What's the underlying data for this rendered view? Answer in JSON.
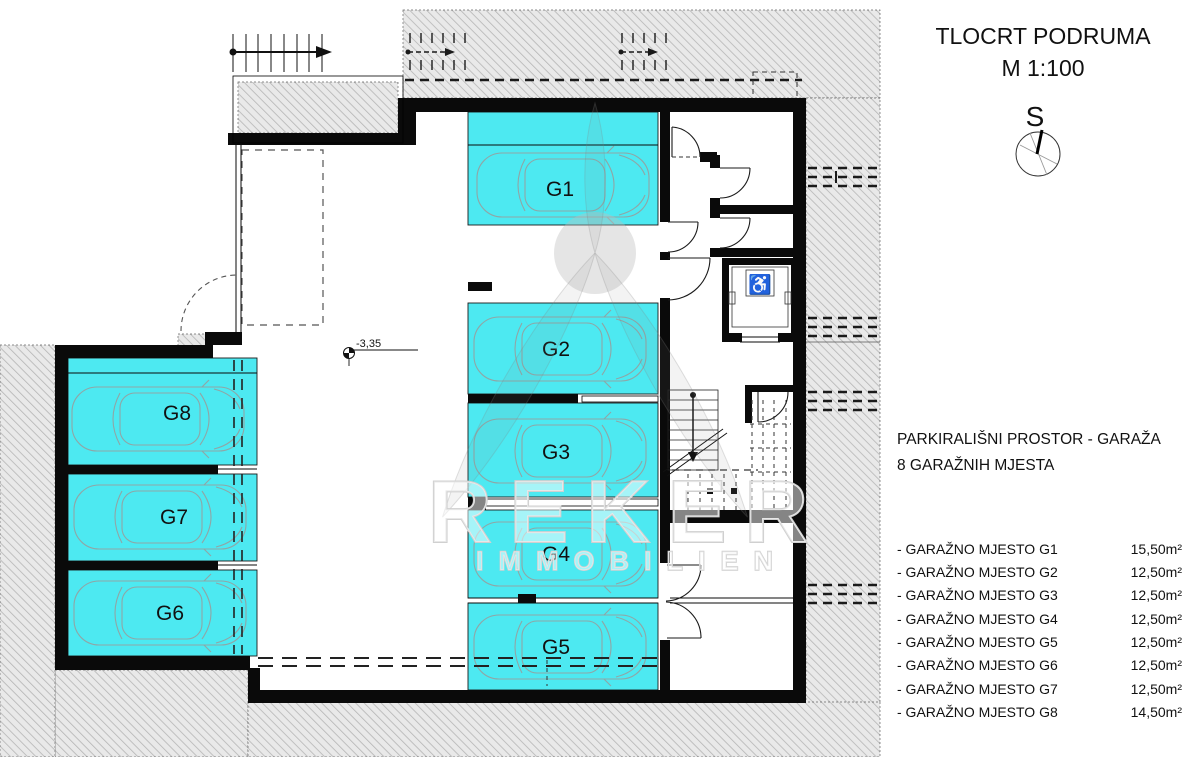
{
  "header": {
    "title": "TLOCRT PODRUMA",
    "scale": "M 1:100",
    "compass_label": "S"
  },
  "summary": {
    "line1": "PARKIRALIŠNI PROSTOR - GARAŽA",
    "line2": "8  GARAŽNIH MJESTA"
  },
  "stalls": [
    {
      "label": "G1",
      "area": "15,50m²"
    },
    {
      "label": "G2",
      "area": "12,50m²"
    },
    {
      "label": "G3",
      "area": "12,50m²"
    },
    {
      "label": "G4",
      "area": "12,50m²"
    },
    {
      "label": "G5",
      "area": "12,50m²"
    },
    {
      "label": "G6",
      "area": "12,50m²"
    },
    {
      "label": "G7",
      "area": "12,50m²"
    },
    {
      "label": "G8",
      "area": "14,50m²"
    }
  ],
  "legend": {
    "rows": [
      {
        "label": "- GARAŽNO MJESTO G1",
        "area": "15,50m²"
      },
      {
        "label": "- GARAŽNO MJESTO G2",
        "area": "12,50m²"
      },
      {
        "label": "- GARAŽNO MJESTO G3",
        "area": "12,50m²"
      },
      {
        "label": "- GARAŽNO MJESTO G4",
        "area": "12,50m²"
      },
      {
        "label": "- GARAŽNO MJESTO G5",
        "area": "12,50m²"
      },
      {
        "label": "- GARAŽNO MJESTO G6",
        "area": "12,50m²"
      },
      {
        "label": "- GARAŽNO MJESTO G7",
        "area": "12,50m²"
      },
      {
        "label": "- GARAŽNO MJESTO G8",
        "area": "14,50m²"
      }
    ]
  },
  "annotations": {
    "level": "-3,35"
  },
  "watermark": {
    "brand": "REKER",
    "sub": "IMMOBILIEN"
  },
  "icons": {
    "wheelchair": "♿"
  },
  "colors": {
    "stall_fill": "#4DE9F1",
    "wall": "#000000",
    "hatch_line": "#B5B5B5",
    "car_outline": "#8FA6A6"
  }
}
